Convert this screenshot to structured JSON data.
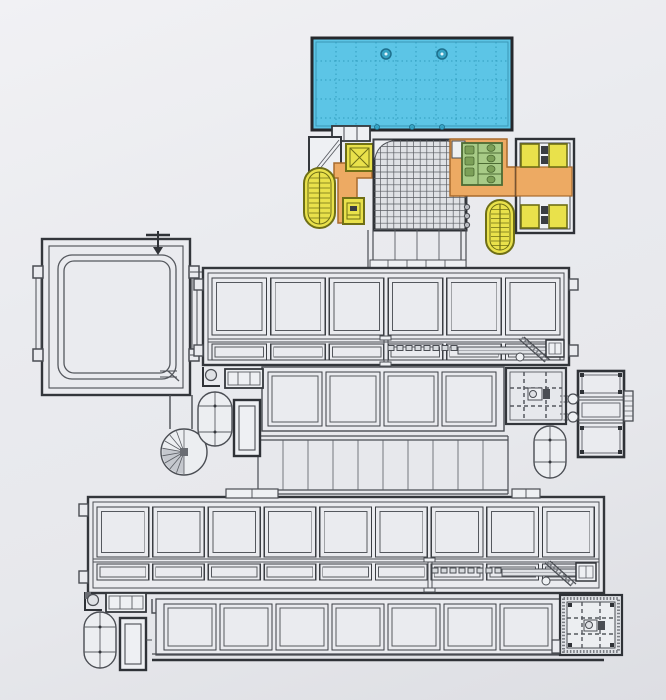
{
  "figure": {
    "kind": "architectural floor plan drawing",
    "visible_text": [],
    "levels": [
      "entry block with glazed roof",
      "upper hall",
      "stepped spine",
      "lower hall",
      "basement row"
    ]
  },
  "palette": {
    "paper": "#e9eaee",
    "room_fill": "#eef0f3",
    "line": "#4a4d53",
    "wall": "#2f3237",
    "pool_blue": "#5cc5e6",
    "pool_grid_blue": "#2f9dbd",
    "circulation_orange": "#edaa63",
    "orange_outline": "#a86a2d",
    "core_yellow": "#e9e14b",
    "yellow_outline": "#6f6f16",
    "toilet_green": "#a8cb87",
    "green_outline": "#4c6b33",
    "grid_fill": "#dfe1e5",
    "shadow_gray": "#c5c8ce"
  },
  "components": {
    "glazed_roof": {
      "name": "glazed-roof-canopy",
      "color_key": "pool_blue",
      "grid": "dotted",
      "round_columns": 2,
      "edge_dots": 3
    },
    "upper_hall": {
      "name": "upper-hall",
      "large_bays": 6,
      "aisle_bays": 6
    },
    "lower_hall": {
      "name": "lower-hall",
      "large_bays": 9,
      "aisle_bays": 9
    },
    "basement_row": {
      "name": "basement-row",
      "bays": 7
    },
    "stepped_spine": {
      "name": "stepped-spine",
      "bays": 10
    },
    "mid_terrace": {
      "name": "mid-terrace-bays",
      "bays": 4
    },
    "oval_stair_towers": {
      "name": "oval-stair-tower",
      "count": 4,
      "color_key": "core_yellow"
    },
    "elevator_cores": {
      "name": "elevator-core",
      "count": 2,
      "color_key": "core_yellow"
    },
    "elevator_bank": {
      "name": "elevator-bank",
      "cabs": 4,
      "color_key": "core_yellow"
    },
    "wc_block": {
      "name": "wc-block",
      "color_key": "toilet_green"
    },
    "circulation_bridge": {
      "name": "circulation-bridge",
      "color_key": "circulation_orange"
    },
    "square_pavilion": {
      "name": "square-pavilion-with-loop-track"
    },
    "spiral_stair": {
      "name": "spiral-stair"
    },
    "plant_rooms_dashed": {
      "name": "plant-room",
      "count": 2
    },
    "tank_capsules": {
      "name": "tank-capsule",
      "count": 3
    },
    "conveyors": {
      "name": "conveyor-run",
      "count": 2
    },
    "escalators": {
      "name": "escalator-diagonal",
      "count": 2
    }
  }
}
